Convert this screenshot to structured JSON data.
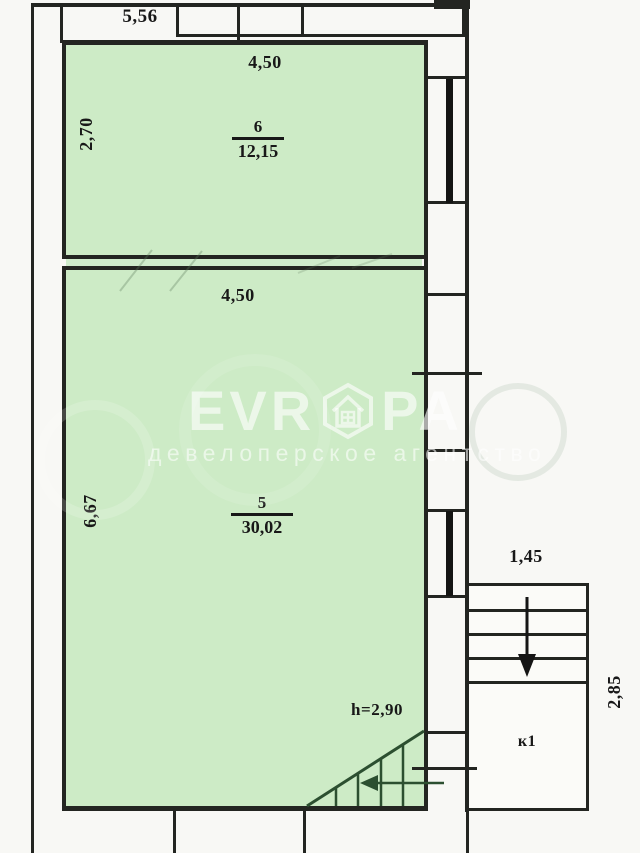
{
  "plan": {
    "dimensions": {
      "outer_top_width": "5,56"
    },
    "rooms": [
      {
        "number": "6",
        "area": "12,15",
        "width": "4,50",
        "depth": "2,70"
      },
      {
        "number": "5",
        "area": "30,02",
        "width": "4,50",
        "depth": "6,67",
        "height_note": "h=2,90"
      }
    ],
    "staircase": {
      "label": "к1",
      "width": "1,45",
      "depth": "2,85"
    },
    "watermark": {
      "brand_prefix": "EVR",
      "brand_suffix": "PA",
      "logo": "hexagon-house-logo",
      "subtitle": "девелоперское агентство"
    },
    "colors": {
      "room_fill": "#cdebc6",
      "wall": "#232521",
      "stair_detail": "#2c4f30",
      "watermark_white": "#ffffff"
    }
  }
}
